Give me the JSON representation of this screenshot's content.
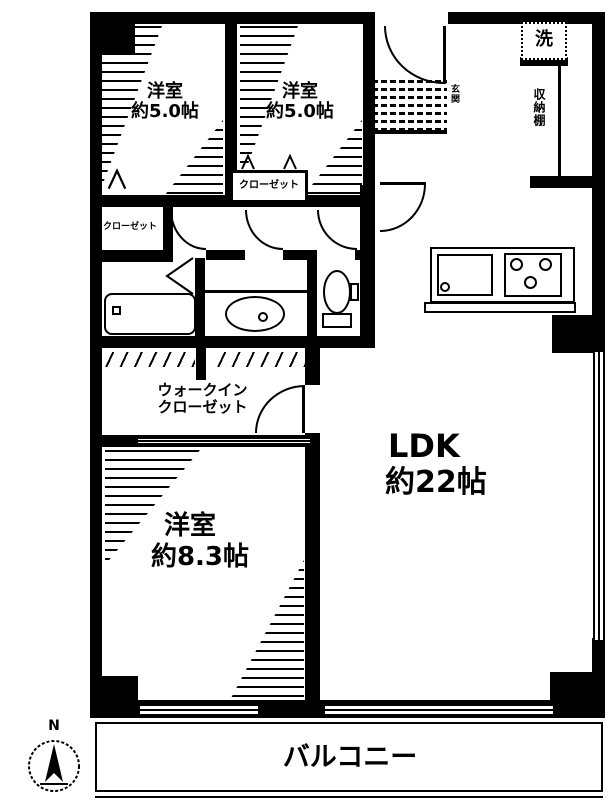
{
  "floorplan": {
    "rooms": {
      "bedroom_a": {
        "name": "洋室",
        "size": "約5.0帖"
      },
      "bedroom_b": {
        "name": "洋室",
        "size": "約5.0帖"
      },
      "bedroom_c": {
        "name": "洋室",
        "size": "約8.3帖"
      },
      "ldk": {
        "name": "LDK",
        "size": "約22帖"
      },
      "walk_in_closet": {
        "label": "ウォークイン\nクローゼット"
      },
      "balcony": {
        "name": "バルコニー"
      }
    },
    "labels": {
      "closet_a": "クローゼット",
      "closet_b": "クローゼット",
      "laundry": "洗",
      "storage_shelf": "収納棚",
      "entrance": "玄関"
    },
    "compass": {
      "north": "N"
    },
    "colors": {
      "wall": "#000000",
      "background": "#ffffff"
    }
  }
}
